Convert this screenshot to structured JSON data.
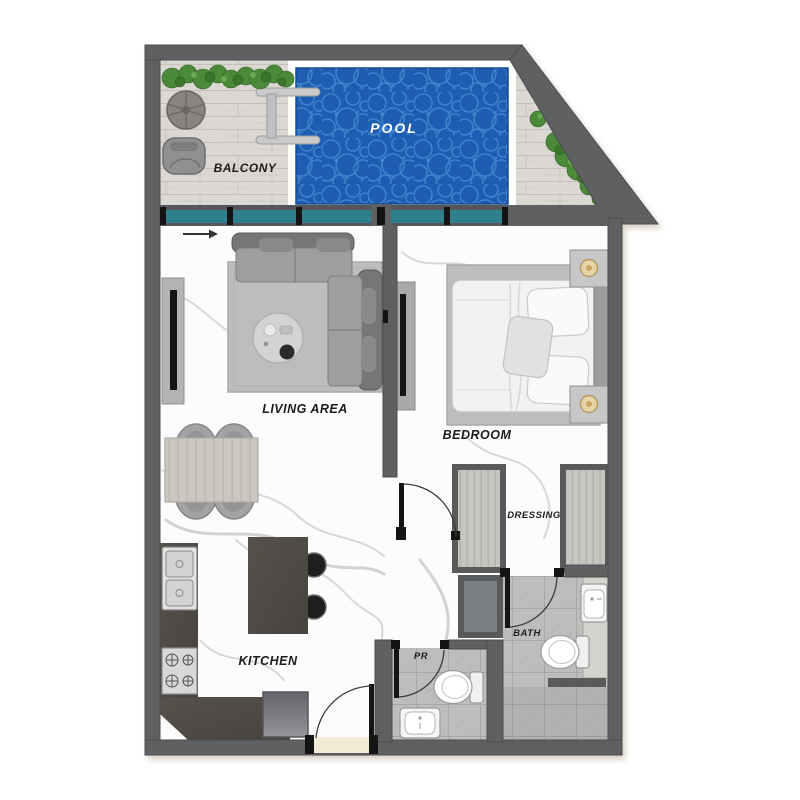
{
  "floor_plan": {
    "rooms": {
      "balcony": "BALCONY",
      "pool": "POOL",
      "living": "LIVING AREA",
      "bedroom": "BEDROOM",
      "kitchen": "KITCHEN",
      "dressing": "DRESSING",
      "bath": "BATH",
      "pr": "PR"
    },
    "colors": {
      "wall": "#5f6062",
      "window_glass": "#2f7f8d",
      "pool_water": "#1e5db2",
      "deck_wood": "#dbd8d3",
      "counter": "#4d4944",
      "tile_floor": "#bdbebc",
      "plant_green": "#4a8a38",
      "entrance_threshold": "#f3ead6"
    }
  }
}
